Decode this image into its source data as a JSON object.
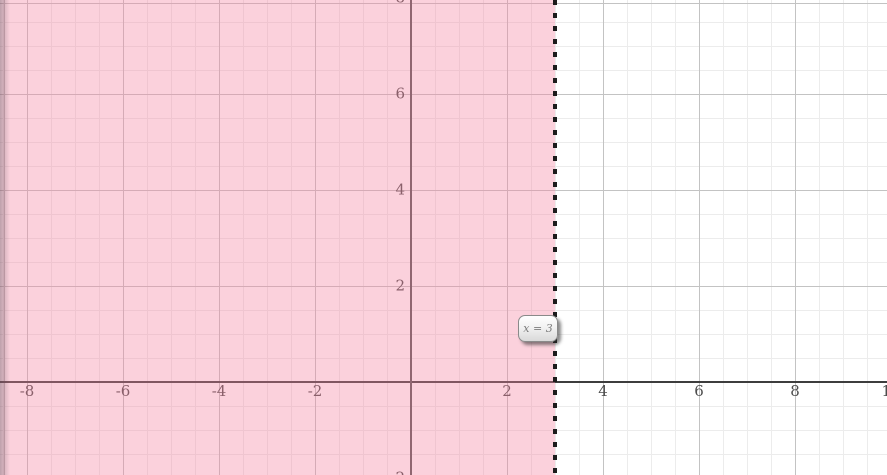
{
  "chart_data": {
    "type": "area",
    "title": "",
    "xlabel": "",
    "ylabel": "",
    "boundary_label": "x = 3",
    "boundary": {
      "equation": "x = 3",
      "x_value": 3,
      "line_style": "dashed",
      "color": "#1c1c1c"
    },
    "shaded_region": "x < 3 (region left of dashed boundary shaded)",
    "shade_color": "#f482a0",
    "shade_opacity": 0.37,
    "x_ticks": [
      -8,
      -6,
      -4,
      -2,
      2,
      4,
      6,
      8,
      10
    ],
    "y_ticks": [
      -2,
      2,
      4,
      6,
      8
    ],
    "xlim": [
      -8.56,
      9.92
    ],
    "ylim": [
      -1.94,
      7.96
    ],
    "grid": true,
    "grid_minor_step": 0.5,
    "grid_major_step": 2,
    "axis_color": "#3d3d3d",
    "tick_label_color": "#4d4d4d"
  }
}
